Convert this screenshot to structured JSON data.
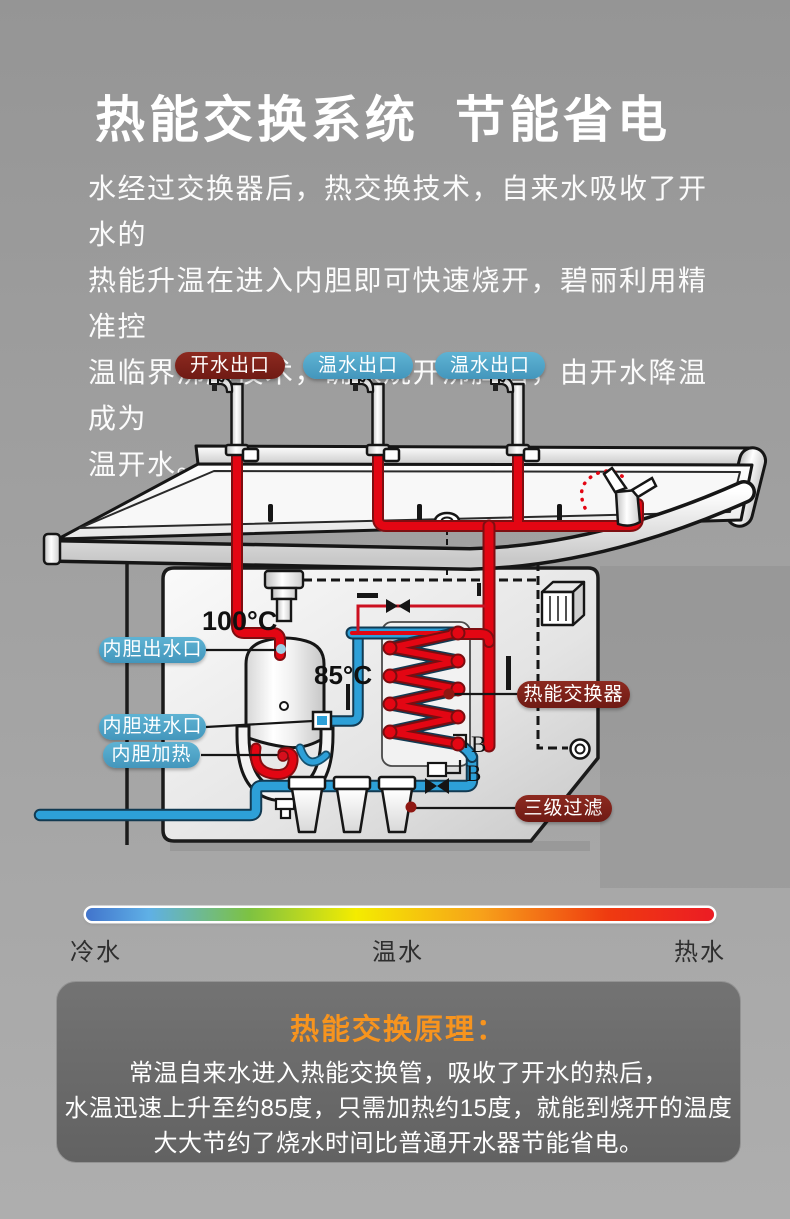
{
  "title": {
    "part1": "热能交换系统",
    "part2": "节能省电"
  },
  "intro": {
    "text": "水经过交换器后，热交换技术，自来水吸收了开水的\n热能升温在进入内胆即可快速烧开，碧丽利用精准控\n温临界沸腾技术，确保烧开沸腾后，由开水降温成为\n温开水。"
  },
  "diagram": {
    "outlets": {
      "hot": "开水出口",
      "warm1": "温水出口",
      "warm2": "温水出口"
    },
    "parts": {
      "tank_outlet": "内胆出水口",
      "tank_inlet": "内胆进水口",
      "tank_heater": "内胆加热",
      "heat_exchanger": "热能交换器",
      "triple_filter": "三级过滤"
    },
    "temps": {
      "tank_top": "100°C",
      "exchanger_out": "85°C"
    },
    "markers": {
      "b1": "B",
      "b2": "B"
    }
  },
  "legend": {
    "cold": "冷水",
    "warm": "温水",
    "hot": "热水"
  },
  "principle": {
    "heading": "热能交换原理：",
    "text": "常温自来水进入热能交换管，吸收了开水的热后，\n水温迅速上升至约85度，只需加热约15度，就能到烧开的温度\n大大节约了烧水时间比普通开水器节能省电。"
  },
  "colors": {
    "hot_pipe": "#e30613",
    "cold_pipe": "#2da0d8",
    "label_blue": "#4fa9ca",
    "label_red": "#7d211b",
    "accent_orange": "#f7941e"
  }
}
